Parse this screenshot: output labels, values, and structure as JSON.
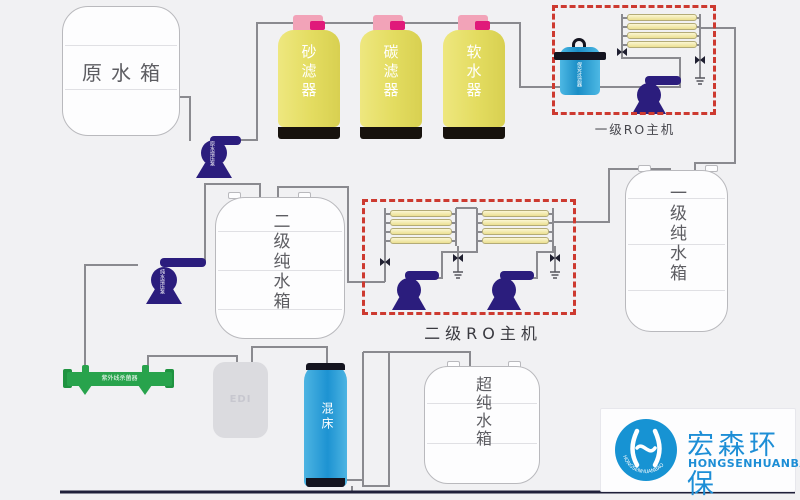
{
  "raw_tank": {
    "label": "原水箱"
  },
  "filters": {
    "sand": "砂滤器",
    "carbon": "碳滤器",
    "softener": "软水器"
  },
  "ro1": {
    "label": "一级RO主机"
  },
  "ro2": {
    "label": "二级RO主机"
  },
  "cartridge_filter": {
    "label": "保安过滤器"
  },
  "pumps": {
    "raw": "原水增压泵",
    "transfer": "纯水增压泵"
  },
  "tanks": {
    "primary": "一级纯水箱",
    "secondary": "二级纯水箱",
    "ultra": "超纯水箱"
  },
  "uv": {
    "label": "紫外线杀菌器"
  },
  "edi": {
    "label": "EDI"
  },
  "mixed_bed": {
    "label": "混床"
  },
  "logo": {
    "cn": "宏森环保",
    "en": "HONGSENHUANBAO",
    "ring": "HONGSENHUANBAO"
  },
  "colors": {
    "background": "#f1f1f3",
    "pipe": "#8a8a8f",
    "dashed_box": "#cd3a30",
    "pump": "#2b1d7d",
    "filter_yellow": "#e3dc60",
    "cap_pink": "#f2a3b8",
    "valve_magenta": "#e01a7a",
    "membrane_yellow": "#f3ebac",
    "cartridge_blue": "#2ea7dc",
    "mixed_bed_blue": "#1d93d2",
    "uv_green": "#28a34c",
    "logo_blue": "#1793d3"
  }
}
